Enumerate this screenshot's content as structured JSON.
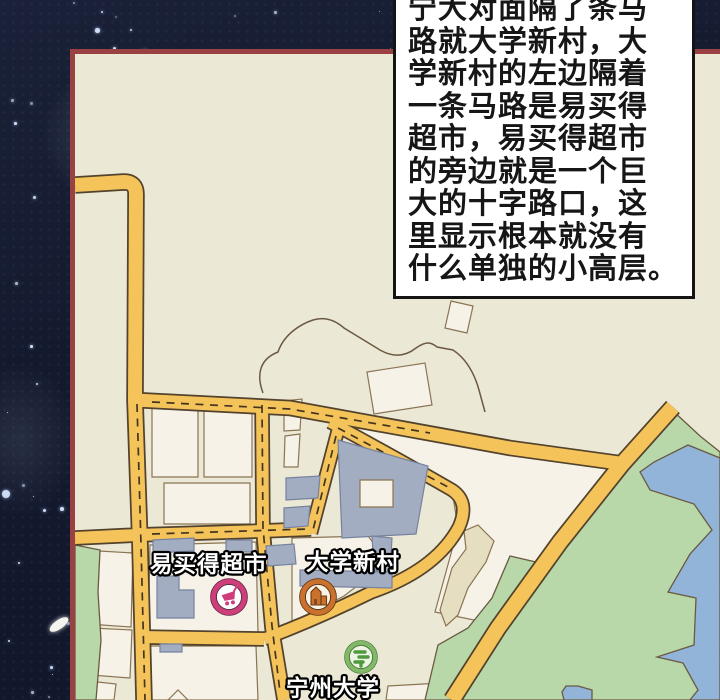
{
  "caption": {
    "text": "宁大对面隔了条马\n路就大学新村，大\n学新村的左边隔着\n一条马路是易买得\n超市，易买得超市\n的旁边就是一个巨\n大的十字路口，这\n里显示根本就没有\n什么单独的小高层。"
  },
  "map": {
    "labels": {
      "supermarket": "易买得超市",
      "village": "大学新村",
      "university": "宁州大学"
    },
    "icons": {
      "supermarket": "shopping-cart-icon",
      "village": "building-icon",
      "university": "tree-icon"
    }
  },
  "palette": {
    "sky": "#141a2d",
    "star": "#d8e6ff",
    "panel_border": "#9a4143",
    "map_bg": "#ece8d6",
    "road_fill": "#f4c45a",
    "road_casing": "#53422c",
    "road_dash": "#43351f",
    "block_fill": "#f6f2e7",
    "block_line": "#8a7454",
    "building_fill": "#a2adc2",
    "building_line": "#76829e",
    "green_fill": "#b9d8aa",
    "water_fill": "#91b4d8",
    "tan_fill": "#e6dec0",
    "outline": "#6a5a42",
    "caption_bg": "#ffffff",
    "caption_border": "#141414",
    "caption_text": "#161616",
    "label_fill": "#ffffff",
    "label_stroke": "#000000",
    "icon_pink": "#cf3e7b",
    "icon_orange": "#c9712d",
    "icon_green": "#82b968"
  }
}
